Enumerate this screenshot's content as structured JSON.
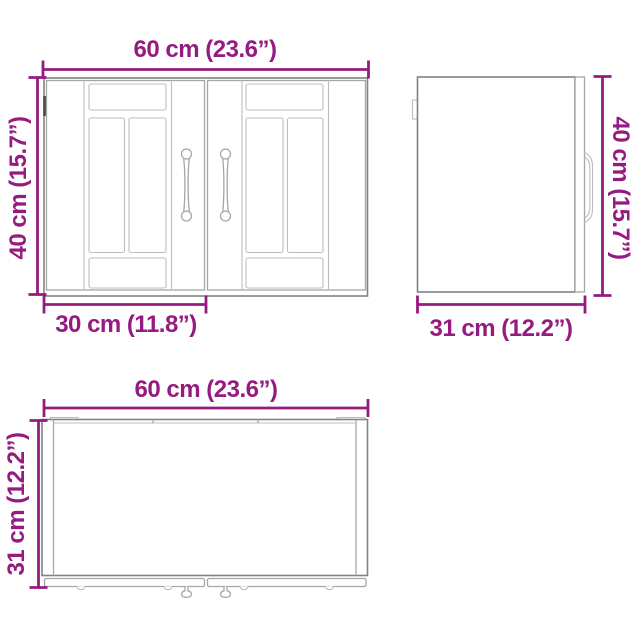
{
  "colors": {
    "background": "#ffffff",
    "dimension": "#951b81",
    "outline_dark": "#828282",
    "outline_mid": "#a6a6a6",
    "outline_light": "#bdbdbd",
    "hinge_dark": "#4f4f4f"
  },
  "views": {
    "front": {
      "width_label": "60 cm (23.6”)",
      "height_label": "40 cm (15.7”)",
      "door_width_label": "30 cm (11.8”)"
    },
    "side": {
      "height_label": "40 cm (15.7”)",
      "depth_label": "31 cm (12.2”)"
    },
    "top": {
      "width_label": "60 cm (23.6”)",
      "depth_label": "31 cm (12.2”)"
    }
  }
}
